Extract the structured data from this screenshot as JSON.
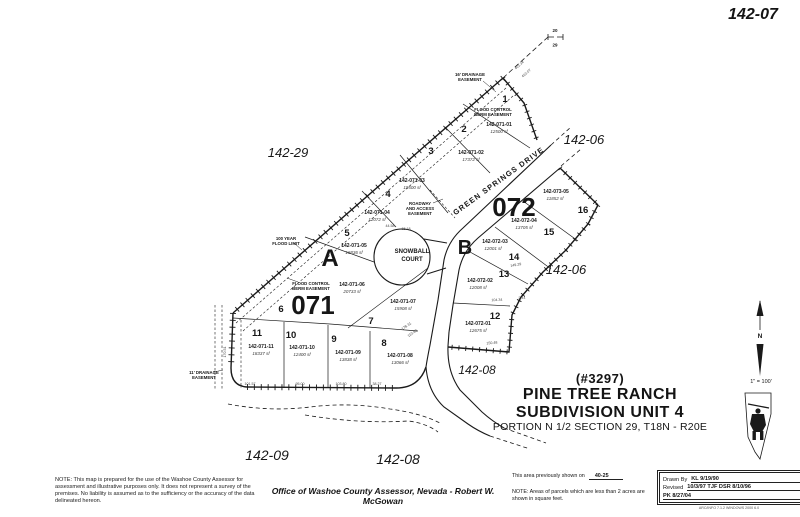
{
  "sheet": {
    "number": "142-07"
  },
  "title_block": {
    "map_id": "(#3297)",
    "line1": "PINE TREE RANCH",
    "line2": "SUBDIVISION UNIT 4",
    "line3": "PORTION N 1/2 SECTION 29, T18N - R20E"
  },
  "map": {
    "scale": "1\" = 100'",
    "north": "N",
    "section_corner": {
      "top": "20",
      "bottom": "29"
    },
    "blocks": [
      {
        "letter": "A",
        "number": "071"
      },
      {
        "letter": "B",
        "number": "072"
      }
    ],
    "streets": {
      "snowball_line1": "SNOWBALL",
      "snowball_line2": "COURT",
      "green_springs": "GREEN SPRINGS DRIVE"
    },
    "neighbors": [
      "142-29",
      "142-06",
      "142-06",
      "142-08",
      "142-09",
      "142-08"
    ],
    "lots": [
      {
        "lot": "1",
        "apn": "142-071-01",
        "area": "12500 sf"
      },
      {
        "lot": "2",
        "apn": "142-071-02",
        "area": "17372 sf"
      },
      {
        "lot": "3",
        "apn": "142-071-03",
        "area": "19500 sf"
      },
      {
        "lot": "4",
        "apn": "142-071-04",
        "area": "12072 sf"
      },
      {
        "lot": "5",
        "apn": "142-071-05",
        "area": "16836 sf"
      },
      {
        "lot": "6",
        "apn": "142-071-06",
        "area": "20733 sf"
      },
      {
        "lot": "7",
        "apn": "142-071-07",
        "area": "15908 sf"
      },
      {
        "lot": "8",
        "apn": "142-071-08",
        "area": "13066 sf"
      },
      {
        "lot": "9",
        "apn": "142-071-09",
        "area": "13838 sf"
      },
      {
        "lot": "10",
        "apn": "142-071-10",
        "area": "12400 sf"
      },
      {
        "lot": "11",
        "apn": "142-071-11",
        "area": "18337 sf"
      },
      {
        "lot": "12",
        "apn": "142-072-01",
        "area": "12675 sf"
      },
      {
        "lot": "13",
        "apn": "142-072-02",
        "area": "12008 sf"
      },
      {
        "lot": "14",
        "apn": "142-072-03",
        "area": "12001 sf"
      },
      {
        "lot": "15",
        "apn": "142-072-04",
        "area": "13705 sf"
      },
      {
        "lot": "16",
        "apn": "142-073-05",
        "area": "11852 sf"
      }
    ],
    "easements": [
      {
        "lines": [
          "16' DRAINAGE",
          "EASEMENT"
        ]
      },
      {
        "lines": [
          "FLOOD CONTROL",
          "BERM EASEMENT"
        ]
      },
      {
        "lines": [
          "ROADWAY",
          "AND ACCESS",
          "EASEMENT"
        ]
      },
      {
        "lines": [
          "100 YEAR",
          "FLOOD LIMIT"
        ]
      },
      {
        "lines": [
          "FLOOD CONTROL",
          "BERM EASEMENT"
        ]
      },
      {
        "lines": [
          "11' DRAINAGE",
          "EASEMENT"
        ]
      }
    ],
    "dimensions": [
      "401.34",
      "410.07",
      "170.51",
      "101.57",
      "95.00",
      "103.80",
      "38.27",
      "178.31",
      "110.80",
      "44.58",
      "15.18",
      "104.34",
      "2.44",
      "149.29",
      "150.48"
    ]
  },
  "footer": {
    "disclaimer": "NOTE: This map is prepared for the use of the Washoe County Assessor for assessment and illustrative purposes only.  It does not represent a survey of the premises.  No liability is assumed as to the sufficiency or the accuracy of the data delineated hereon.",
    "office_line": "Office of Washoe County Assessor, Nevada - Robert W. McGowan",
    "previously_shown_label": "This area previously shown on",
    "previously_shown_value": "40-25",
    "areas_note": "NOTE:  Areas of parcels which are less than 2 acres are shown in square feet.",
    "revision_box": {
      "row1_label": "Drawn By",
      "row1_value": "KL 9/19/90",
      "row2_label": "Revised",
      "row2_value": "10/3/97 TJF   DSR 8/10/96",
      "row3": "PK  8/27/04",
      "plot_info": "ARC/INFO 7.1.2   WINDOWS 2000 6.0"
    }
  }
}
